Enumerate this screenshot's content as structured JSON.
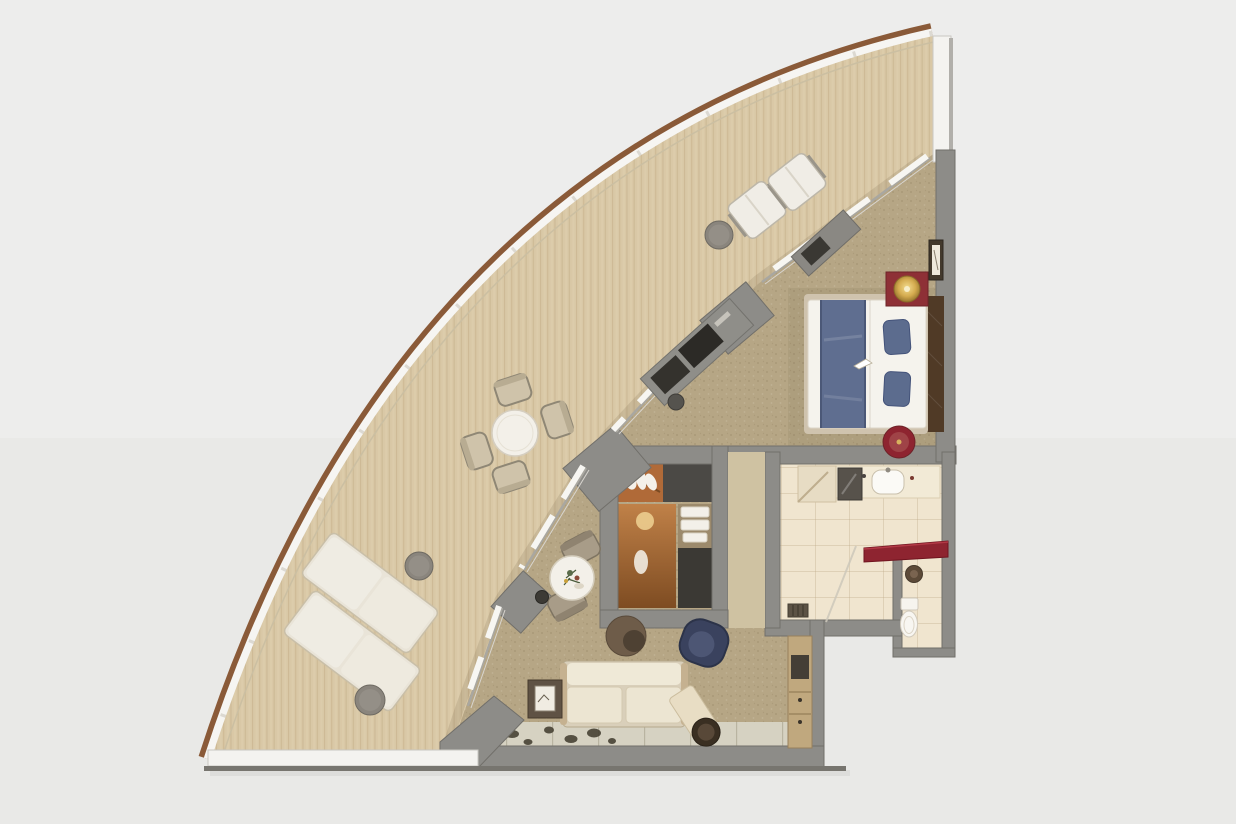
{
  "scene": {
    "title": "Curved suite floor plan — top-down 3D render",
    "view": "top-down cutaway",
    "shape": "quarter-wedge with curved hull balcony"
  },
  "palette": {
    "bg": "#ededec",
    "bgLower": "#e9e9e7",
    "hullWood": "#8a5a38",
    "hullWhite": "#f6f5f2",
    "deck": "#d9c8a6",
    "deckLine": "#c2ad87",
    "wall": "#8d8c88",
    "wallEdge": "#716f6a",
    "wallLit": "#cfc2a2",
    "wallWhite": "#f4f3f0",
    "glassTrack": "#a9a7a0",
    "glassPanel": "#f7f6f2",
    "carpet": "#b6a685",
    "tileFloor": "#d6d2c2",
    "bathFloor": "#f0e5cf",
    "counter": "#f2ead6",
    "redLacquer": "#8e2430",
    "redWine": "#8e3036",
    "gold": "#d4ab4f",
    "bedWhite": "#f5f3ed",
    "runnerBlue": "#5f6e90",
    "pillowBlue": "#5c6c8e",
    "headboard": "#503a26",
    "sofaCream": "#e9e2cf",
    "sofaFrame": "#c5b190",
    "armchairNavy": "#3a425e",
    "ottoman": "#6e5c49",
    "ottomanDark": "#4e4133",
    "bolsterEnd": "#3a2f22",
    "loungerWhite": "#efece3",
    "chairTaupe": "#cfc3aa",
    "chairFrame": "#8f8775",
    "chairWhite": "#f0ede6",
    "tableWhite": "#f3f0e9",
    "sideGray": "#8a857d",
    "closetWood": "#b06a38",
    "closetDark": "#4b4945",
    "cabinetDark": "#3b3934",
    "towel": "#f3f0e9",
    "toiletWhite": "#f8f6f1",
    "spotDark": "#3f3a2c",
    "credenza": "#8f8e89",
    "deskWood": "#c0a87e"
  },
  "rooms": [
    {
      "id": "balcony",
      "label": "Wraparound balcony terrace"
    },
    {
      "id": "bedroom",
      "label": "Bedroom"
    },
    {
      "id": "living",
      "label": "Living area"
    },
    {
      "id": "wardrobe",
      "label": "Walk-in wardrobe"
    },
    {
      "id": "bathroom",
      "label": "Bathroom"
    },
    {
      "id": "toilet",
      "label": "Toilet room"
    },
    {
      "id": "entry",
      "label": "Entry tile strip"
    }
  ],
  "furniture": {
    "balcony": [
      "Sun lounger",
      "Sun lounger",
      "Lounger side table",
      "Lounger side table",
      "Round dining table",
      "Dining chair",
      "Dining chair",
      "Dining chair",
      "Dining chair",
      "Lounge chair",
      "Lounge chair",
      "Drinks table"
    ],
    "bedroom": [
      "Double bed with blue runner",
      "Headboard panel",
      "Nightstand with lamp",
      "Bedside stool",
      "Wall art",
      "TV credenza",
      "Vanity stool",
      "Luggage bench"
    ],
    "living": [
      "Sofa",
      "Side table",
      "Bistro table",
      "Bistro chair",
      "Bistro chair",
      "Ice bucket",
      "Ottoman",
      "Armchair",
      "Bolster cushion",
      "Console desk",
      "Entry rug"
    ],
    "wardrobe": [
      "Hanging rail with garments",
      "Shelves with towels",
      "Lower cabinet"
    ],
    "bathroom": [
      "Vanity counter",
      "Mirror",
      "Sink",
      "Red counter",
      "Shower with drain",
      "Toilet",
      "Wall basin"
    ]
  }
}
